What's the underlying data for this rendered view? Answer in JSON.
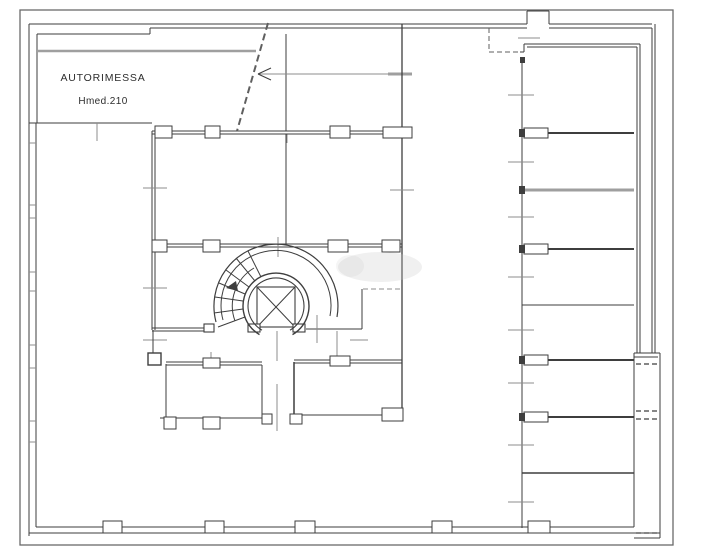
{
  "labels": {
    "garage": "AUTORIMESSA",
    "height": "Hmed.210"
  },
  "colors": {
    "ink": "#3e3e3e",
    "gray": "#9f9f9f",
    "tick": "#8c8c8c",
    "soft": "#5f5f5f",
    "border": "#6a6a6a",
    "paper": "#ffffff",
    "wm": "#c9c9c9"
  },
  "plan": {
    "lines": [
      [
        29,
        24,
        527,
        24
      ],
      [
        549,
        24,
        652,
        24
      ],
      [
        527,
        24,
        527,
        11
      ],
      [
        527,
        11,
        549,
        11
      ],
      [
        549,
        11,
        549,
        24
      ],
      [
        37,
        34,
        150,
        34
      ],
      [
        150,
        34,
        150,
        28
      ],
      [
        150,
        28,
        527,
        28
      ],
      [
        549,
        28,
        652,
        28
      ],
      [
        29,
        24,
        29,
        536
      ],
      [
        37,
        34,
        37,
        123
      ],
      [
        36,
        123,
        36,
        527
      ],
      [
        29,
        123,
        152,
        123
      ],
      [
        97,
        123,
        97,
        141,
        1,
        "tick"
      ],
      [
        286,
        34,
        286,
        131
      ],
      [
        287,
        134,
        287,
        143,
        1,
        "tick"
      ],
      [
        258,
        74,
        412,
        74,
        1,
        "tick"
      ],
      [
        258,
        74,
        271,
        68
      ],
      [
        258,
        74,
        271,
        80
      ],
      [
        388,
        74,
        412,
        74,
        3,
        "gray"
      ],
      [
        38,
        51,
        256,
        51,
        2.5,
        "gray"
      ],
      [
        29,
        143,
        36,
        143,
        1,
        "tick"
      ],
      [
        29,
        205,
        36,
        205,
        1,
        "tick"
      ],
      [
        29,
        218,
        36,
        218,
        1,
        "tick"
      ],
      [
        29,
        272,
        36,
        272,
        1,
        "tick"
      ],
      [
        29,
        291,
        36,
        291,
        1,
        "tick"
      ],
      [
        29,
        345,
        36,
        345,
        1,
        "tick"
      ],
      [
        29,
        368,
        36,
        368,
        1,
        "tick"
      ],
      [
        29,
        421,
        36,
        421,
        1,
        "tick"
      ],
      [
        29,
        442,
        36,
        442,
        1,
        "tick"
      ],
      [
        36,
        527,
        634,
        527
      ],
      [
        29,
        533,
        660,
        533
      ],
      [
        152,
        131,
        402,
        131
      ],
      [
        152,
        134,
        402,
        134
      ],
      [
        152,
        131,
        152,
        330
      ],
      [
        155,
        134,
        155,
        330
      ],
      [
        286,
        134,
        286,
        244
      ],
      [
        402,
        24,
        402,
        418,
        1.3
      ],
      [
        143,
        188,
        167,
        188,
        1,
        "tick"
      ],
      [
        390,
        190,
        414,
        190,
        1,
        "tick"
      ],
      [
        152,
        244,
        402,
        244
      ],
      [
        152,
        247,
        402,
        247
      ],
      [
        278,
        237,
        278,
        257,
        1,
        "tick"
      ],
      [
        143,
        288,
        167,
        288,
        1,
        "tick"
      ],
      [
        143,
        340,
        167,
        340,
        1,
        "tick"
      ],
      [
        153,
        330,
        153,
        353
      ],
      [
        152,
        328,
        213,
        328
      ],
      [
        152,
        331,
        206,
        331
      ],
      [
        306,
        329,
        362,
        329
      ],
      [
        362,
        289,
        362,
        329
      ],
      [
        350,
        340,
        368,
        340,
        1,
        "tick"
      ],
      [
        317,
        315,
        317,
        343,
        1,
        "tick"
      ],
      [
        337,
        331,
        337,
        361,
        1,
        "tick"
      ],
      [
        277,
        331,
        277,
        361,
        1,
        "tick"
      ],
      [
        277,
        384,
        277,
        431,
        1,
        "tick"
      ],
      [
        257,
        287,
        295,
        327
      ],
      [
        295,
        287,
        257,
        327
      ],
      [
        245,
        317,
        218,
        327
      ],
      [
        243,
        309,
        214,
        313
      ],
      [
        243,
        301,
        215,
        297
      ],
      [
        245,
        294,
        219,
        283
      ],
      [
        249,
        287,
        226,
        270
      ],
      [
        255,
        281,
        236,
        258
      ],
      [
        261,
        277,
        248,
        251
      ],
      [
        166,
        364,
        166,
        418
      ],
      [
        166,
        362,
        262,
        362
      ],
      [
        166,
        365,
        262,
        365
      ],
      [
        262,
        365,
        262,
        418
      ],
      [
        160,
        418,
        262,
        418
      ],
      [
        211,
        352,
        211,
        360,
        1,
        "tick"
      ],
      [
        294,
        362,
        294,
        419,
        1.5
      ],
      [
        294,
        360,
        402,
        360
      ],
      [
        294,
        363,
        402,
        363
      ],
      [
        294,
        415,
        384,
        415
      ],
      [
        522,
        57,
        522,
        528
      ],
      [
        520,
        52,
        524,
        52
      ],
      [
        524,
        44,
        524,
        52
      ],
      [
        524,
        44,
        640,
        44
      ],
      [
        527,
        47,
        637,
        47
      ],
      [
        637,
        47,
        637,
        353
      ],
      [
        640,
        44,
        640,
        353
      ],
      [
        652,
        28,
        652,
        353
      ],
      [
        655,
        24,
        655,
        353
      ],
      [
        518,
        38,
        540,
        38,
        1,
        "tick"
      ],
      [
        634,
        353,
        660,
        353
      ],
      [
        634,
        357,
        658,
        357
      ],
      [
        634,
        353,
        634,
        527
      ],
      [
        660,
        353,
        660,
        538
      ],
      [
        634,
        538,
        660,
        538
      ],
      [
        546,
        133,
        634,
        133,
        2
      ],
      [
        522,
        190,
        634,
        190,
        3,
        "gray"
      ],
      [
        546,
        249,
        634,
        249,
        2
      ],
      [
        522,
        305,
        634,
        305
      ],
      [
        546,
        360,
        634,
        360,
        2
      ],
      [
        546,
        417,
        634,
        417,
        2
      ],
      [
        522,
        473,
        634,
        473,
        1.5
      ],
      [
        508,
        95,
        534,
        95,
        1,
        "tick"
      ],
      [
        508,
        162,
        534,
        162,
        1,
        "tick"
      ],
      [
        508,
        217,
        534,
        217,
        1,
        "tick"
      ],
      [
        508,
        277,
        534,
        277,
        1,
        "tick"
      ],
      [
        508,
        330,
        534,
        330,
        1,
        "tick"
      ],
      [
        508,
        383,
        534,
        383,
        1,
        "tick"
      ],
      [
        508,
        445,
        534,
        445,
        1,
        "tick"
      ],
      [
        508,
        502,
        534,
        502,
        1,
        "tick"
      ]
    ],
    "dashed": [
      [
        268,
        23,
        237,
        131,
        2,
        "soft",
        "7 4"
      ],
      [
        363,
        289,
        400,
        289,
        1,
        "tick",
        "5 3"
      ],
      [
        489,
        28,
        489,
        52,
        1,
        "soft",
        "5 3"
      ],
      [
        489,
        52,
        520,
        52,
        1,
        "soft",
        "5 3"
      ],
      [
        636,
        364,
        658,
        364,
        1.5,
        "soft",
        "5 3"
      ],
      [
        636,
        411,
        658,
        411,
        1.5,
        "soft",
        "5 3"
      ],
      [
        636,
        419,
        658,
        419,
        1.5,
        "soft",
        "5 3"
      ],
      [
        636,
        533,
        658,
        533,
        1.5,
        "soft",
        "5 3"
      ]
    ],
    "rects": [
      [
        20,
        10,
        653,
        535,
        "none",
        "border",
        1.3
      ],
      [
        257,
        287,
        38,
        40,
        "none",
        "ink",
        1.1
      ],
      [
        248,
        324,
        12,
        8,
        "paper",
        "ink",
        1.1
      ],
      [
        293,
        324,
        12,
        8,
        "paper",
        "ink",
        1.1
      ],
      [
        204,
        324,
        10,
        8,
        "paper",
        "ink",
        1.1
      ],
      [
        148,
        353,
        13,
        12,
        "paper",
        "ink",
        1.4
      ],
      [
        155,
        126,
        17,
        12,
        "paper",
        "ink",
        1
      ],
      [
        205,
        126,
        15,
        12,
        "paper",
        "ink",
        1
      ],
      [
        330,
        126,
        20,
        12,
        "paper",
        "ink",
        1
      ],
      [
        383,
        127,
        29,
        11,
        "paper",
        "ink",
        1
      ],
      [
        152,
        240,
        15,
        12,
        "paper",
        "ink",
        1
      ],
      [
        203,
        240,
        17,
        12,
        "paper",
        "ink",
        1
      ],
      [
        328,
        240,
        20,
        12,
        "paper",
        "ink",
        1
      ],
      [
        382,
        240,
        18,
        12,
        "paper",
        "ink",
        1
      ],
      [
        164,
        417,
        12,
        12,
        "paper",
        "ink",
        1
      ],
      [
        203,
        417,
        17,
        12,
        "paper",
        "ink",
        1
      ],
      [
        203,
        358,
        17,
        10,
        "paper",
        "ink",
        1
      ],
      [
        262,
        414,
        10,
        10,
        "paper",
        "ink",
        1
      ],
      [
        290,
        414,
        12,
        10,
        "paper",
        "ink",
        1
      ],
      [
        382,
        408,
        21,
        13,
        "paper",
        "ink",
        1
      ],
      [
        330,
        356,
        20,
        10,
        "paper",
        "ink",
        1
      ],
      [
        524,
        128,
        24,
        10,
        "paper",
        "ink",
        1
      ],
      [
        524,
        244,
        24,
        10,
        "paper",
        "ink",
        1
      ],
      [
        524,
        355,
        24,
        10,
        "paper",
        "ink",
        1
      ],
      [
        524,
        412,
        24,
        10,
        "paper",
        "ink",
        1
      ],
      [
        519,
        129,
        6,
        8,
        "ink",
        "none",
        0
      ],
      [
        519,
        186,
        6,
        8,
        "ink",
        "none",
        0
      ],
      [
        519,
        245,
        6,
        8,
        "ink",
        "none",
        0
      ],
      [
        519,
        356,
        6,
        8,
        "ink",
        "none",
        0
      ],
      [
        519,
        413,
        6,
        8,
        "ink",
        "none",
        0
      ],
      [
        520,
        57,
        5,
        6,
        "ink",
        "none",
        0
      ],
      [
        103,
        521,
        19,
        12,
        "paper",
        "ink",
        1
      ],
      [
        205,
        521,
        19,
        12,
        "paper",
        "ink",
        1
      ],
      [
        295,
        521,
        20,
        12,
        "paper",
        "ink",
        1
      ],
      [
        432,
        521,
        20,
        12,
        "paper",
        "ink",
        1
      ],
      [
        528,
        521,
        22,
        12,
        "paper",
        "ink",
        1
      ]
    ],
    "arcs": [
      [
        "M292.5,334.6 A33,33 0 1 0 259.5,334.6",
        "ink",
        1.4
      ],
      [
        "M290,330.2 A28,28 0 1 0 262,330.2",
        "ink",
        1.1
      ],
      [
        "M216,322 A62,62 0 1 1 337,317",
        "ink",
        1.2
      ],
      [
        "M223,320 A55,55 0 1 1 330,316",
        "ink",
        1
      ],
      [
        "M254,268 A44,44 0 0 0 235,321",
        "ink",
        1
      ]
    ],
    "polygons": [
      [
        "226,288 236,281 238,291",
        "ink"
      ]
    ],
    "ellipses": [
      [
        380,
        267,
        42,
        15,
        "wm",
        0.28
      ],
      [
        350,
        266,
        14,
        11,
        "wm",
        0.18
      ]
    ]
  }
}
